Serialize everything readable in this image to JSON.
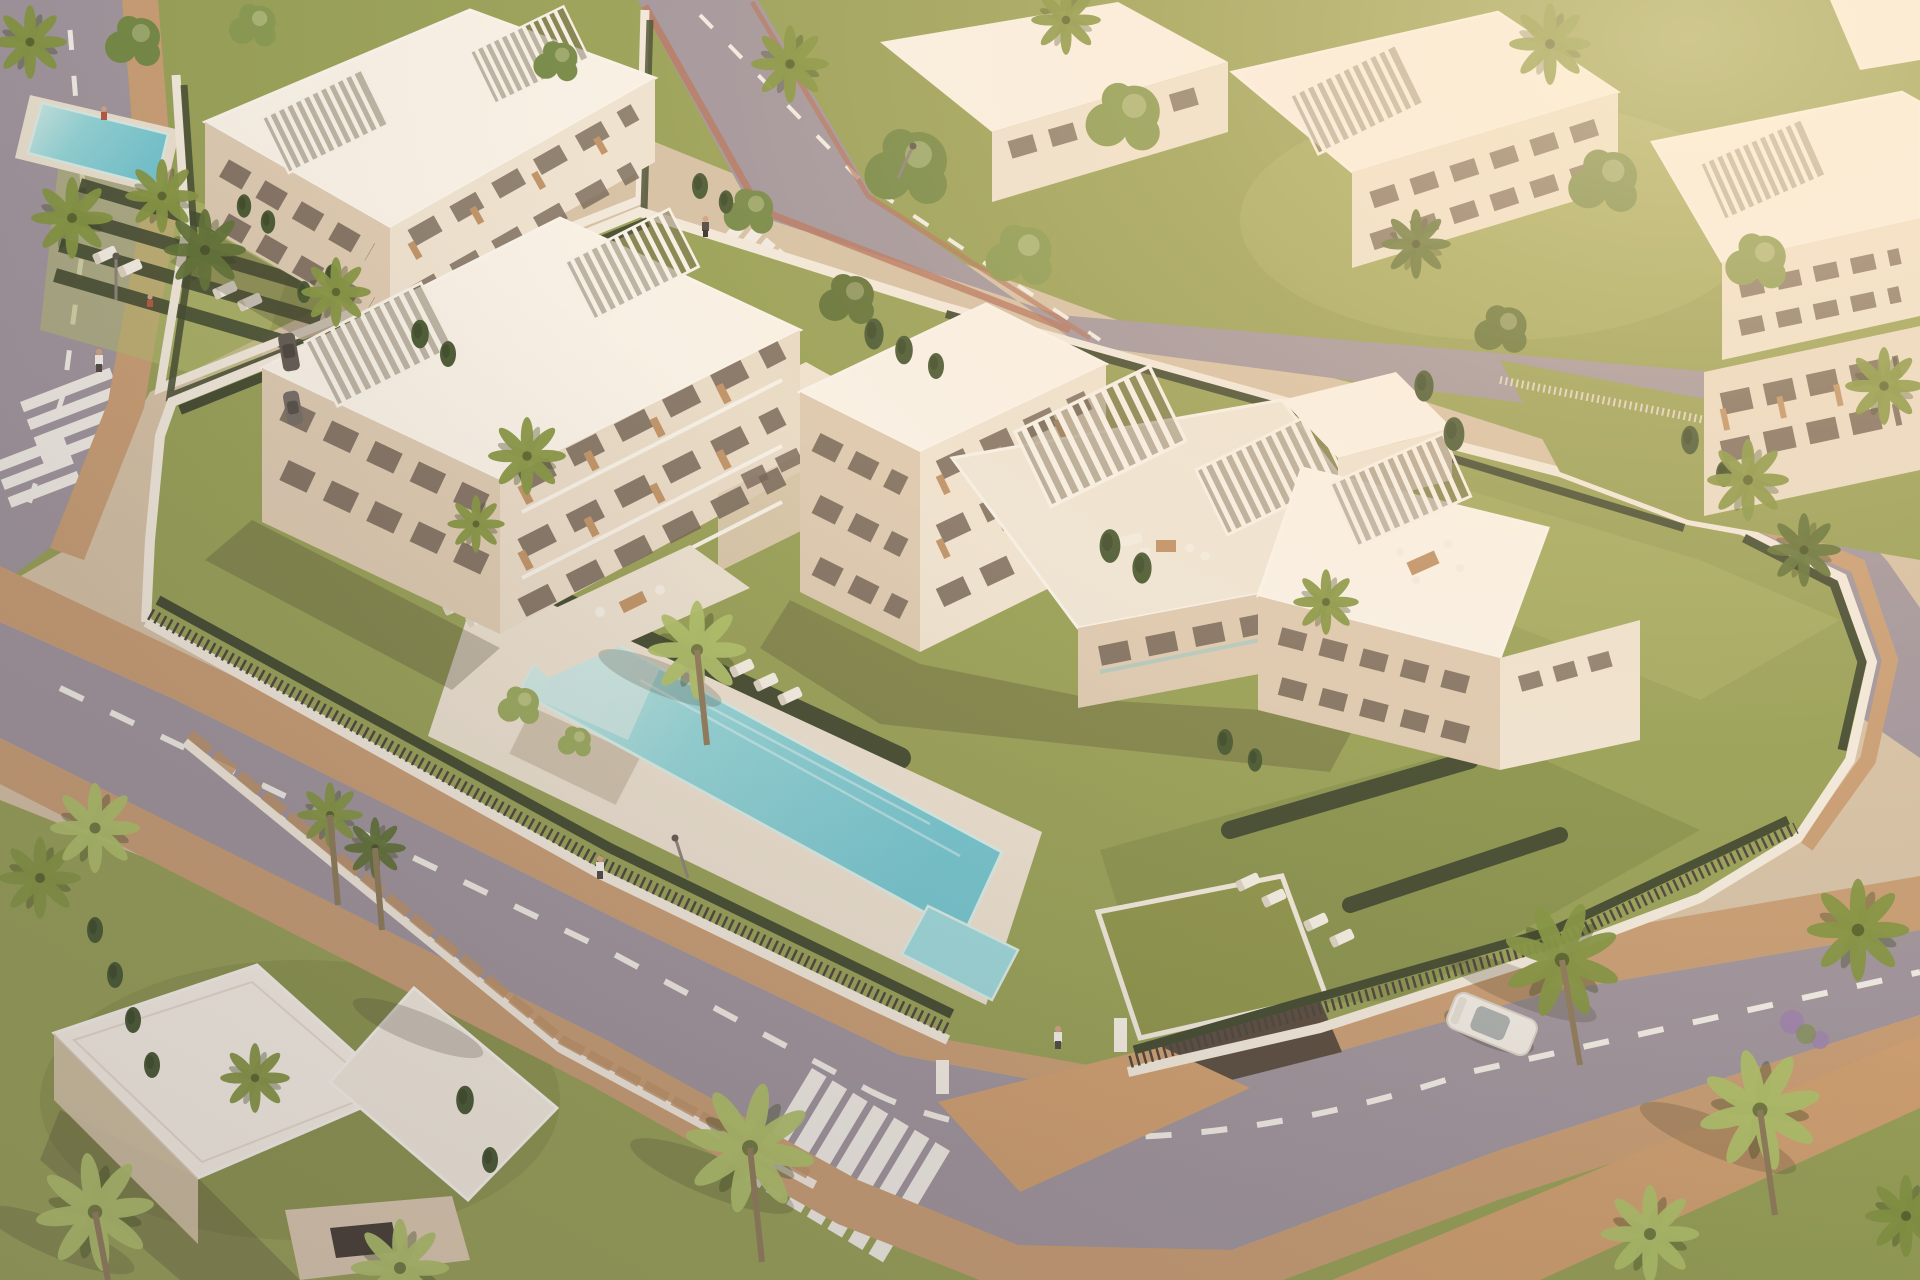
{
  "scene": {
    "type": "architectural-aerial-render",
    "description": "High-angle aerial 3D rendering of a modern white Mediterranean apartment complex at golden hour: two large flat-roofed apartment buildings with slatted roof pergolas and terraces, a turquoise lap pool with a children's pool, olive lawns, dark hedges, a gated entrance with green-roofed garage ramp, ring road with zebra crossings, brick sidewalks, palm and cypress trees, neighbouring complexes around, a flat-roofed villa at bottom-left, one parked white car and a few pedestrians.",
    "view": "aerial oblique, sun from upper right, long soft shadows",
    "inventory": {
      "apartment_buildings_central": 2,
      "neighbour_building_clusters": 5,
      "villa": 1,
      "pools": [
        "main-lap-pool",
        "children-pool",
        "upper-left-lap-pool"
      ],
      "roads": 3,
      "zebra_crosswalks": 4,
      "gated_entrance": 1,
      "garage_green_roof": 1,
      "palm_trees_approx": 26,
      "cypress_trees_approx": 20,
      "shade_trees_approx": 12,
      "sun_loungers_approx": 20,
      "roof_pergolas_approx": 10,
      "pedestrians": 6,
      "vehicles": {
        "white_car_parked": 1,
        "dark_cars_parked": 2
      },
      "street_lamps": 3
    }
  },
  "palette": {
    "base": "#d5c2a6",
    "grass": "#95a054",
    "grass2": "#b2ba6e",
    "grassd": "#6e7b3c",
    "hedge": "#3d472c",
    "road": "#9e949d",
    "mark": "#f2efe8",
    "brick": "#c89d73",
    "brick2": "#cf9f6f",
    "terra": "#b3705a",
    "wall": "#f3ecdf",
    "fence": "#46413a",
    "bsun": "#faf5eb",
    "bmid": "#efe5d3",
    "bmid2": "#e9ddc9",
    "bshade": "#ddcbb2",
    "deck": "#ece3d2",
    "win": "#6e6052",
    "wood": "#bd9164",
    "rail": "#f7f3ea",
    "pool1": "#cfece8",
    "pool2": "#8fd6da",
    "pool3": "#6fc6d2",
    "poolkid": "#9adade",
    "pooledge": "#d8efe9",
    "palm": "#82953f",
    "palmb": "#aec168",
    "palmd": "#5c7033",
    "cyp": "#42552e",
    "tree": "#6f8742",
    "tree2": "#84994e",
    "trunk": "#8d7a58",
    "shad": "rgba(70,60,42,0.28)",
    "skin": "#cfa183",
    "white": "#f6f3ec",
    "dark": "#4a4440"
  }
}
